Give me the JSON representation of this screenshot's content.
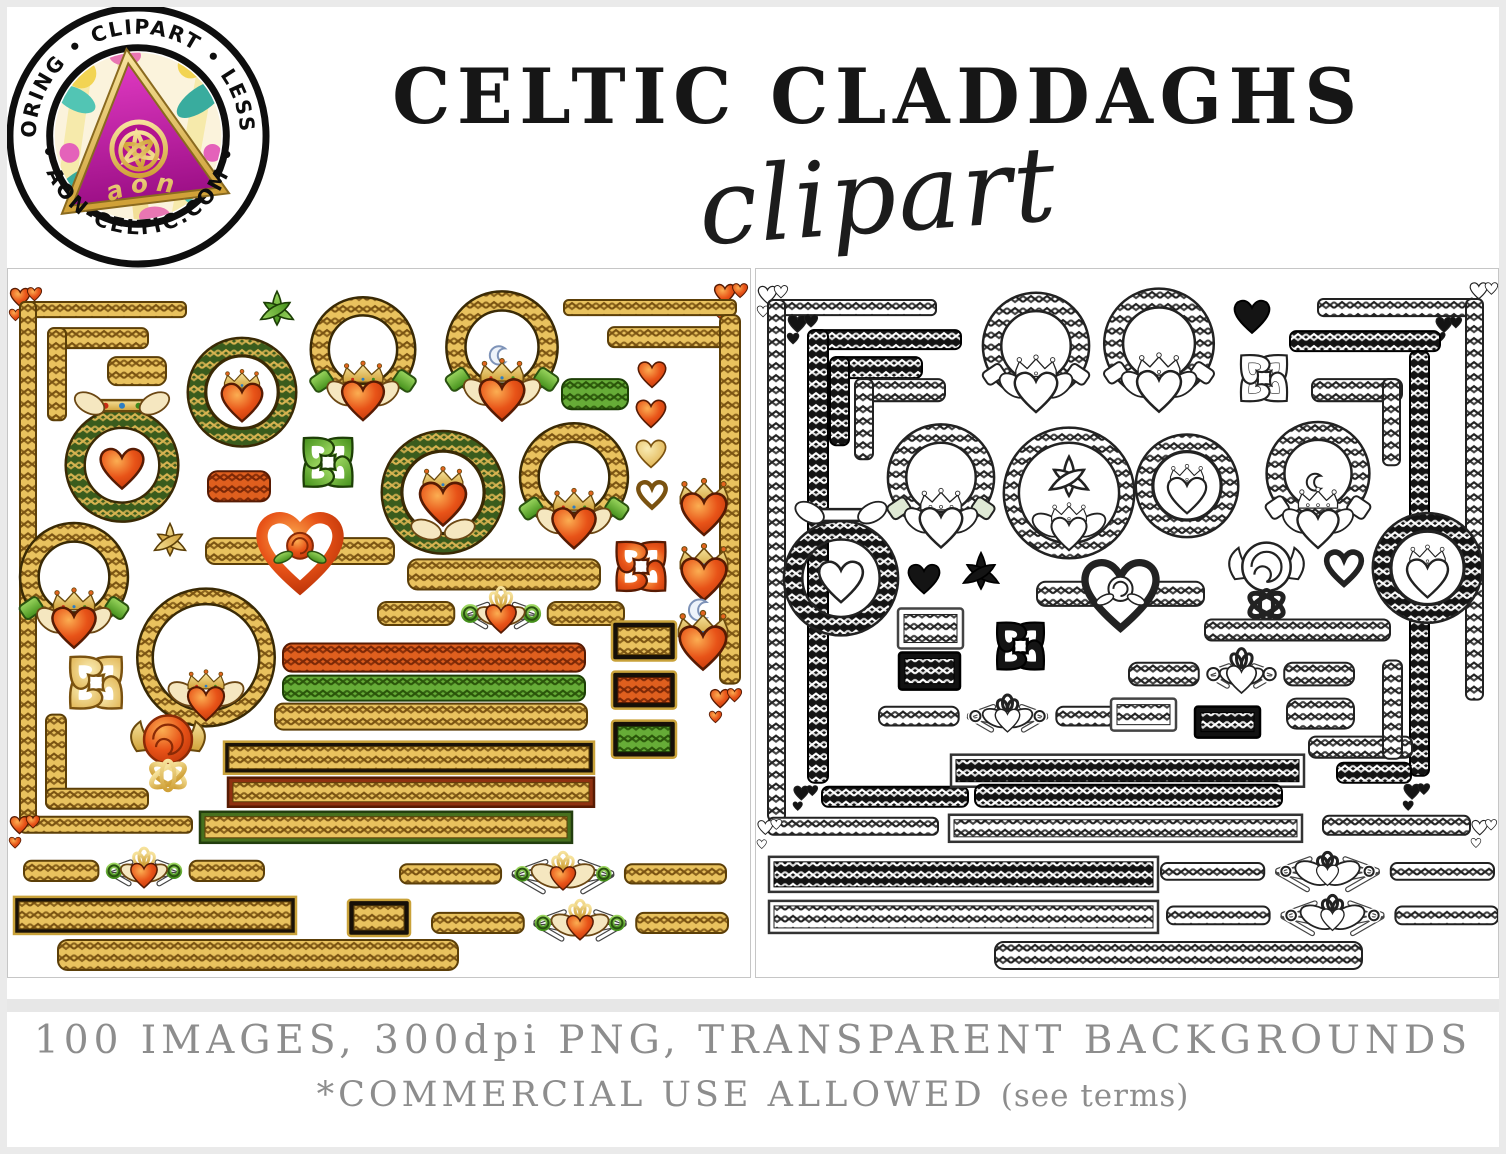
{
  "header": {
    "logo": {
      "ring_text_top": "COLORING • CLIPART • LESSONS",
      "ring_text_bottom": "• AON-CELTIC.COM •",
      "monogram": "aon"
    },
    "title": "CELTIC CLADDAGHS",
    "subtitle": "clipart"
  },
  "footer": {
    "line1": "100 IMAGES, 300dpi PNG, TRANSPARENT BACKGROUNDS",
    "line2_main": "*COMMERCIAL USE ALLOWED",
    "line2_note": "(see terms)",
    "text_color": "#8d8d8d"
  },
  "palette": {
    "schemes": {
      "gold": {
        "base": "#E9C25E",
        "lat": "#7A5312",
        "edge": "#5C3F08"
      },
      "orange": {
        "base": "#DF5F1E",
        "lat": "#7A2706",
        "edge": "#571B03"
      },
      "green": {
        "base": "#66AC37",
        "lat": "#295409",
        "edge": "#1D3F06"
      },
      "dgreen": {
        "base": "#3A5C1D",
        "lat": "#D8B451",
        "edge": "#233E0F"
      },
      "goldh": {
        "base": "#F0D78C",
        "lat": "#B98F2E",
        "edge": "#7A5210"
      },
      "bw": {
        "base": "#FFFFFF",
        "lat": "#222222",
        "edge": "#222222"
      },
      "black": {
        "base": "#141414",
        "lat": "#FFFFFF",
        "edge": "#000000"
      }
    },
    "heart_orange": [
      "#FBAE52",
      "#E85318",
      "#B93107"
    ],
    "heart_gold": [
      "#F9ECB4",
      "#DCA93F"
    ],
    "cuff_green": [
      "#9BD65F",
      "#44901B"
    ],
    "gold_metal": [
      "#F6E29B",
      "#D0A138"
    ],
    "magenta": [
      "#E23BC4",
      "#9C0F86"
    ],
    "cream": "#F5E7C0",
    "ink": "#222222"
  },
  "panels": {
    "left": {
      "name": "color-clipart-panel",
      "items": [
        {
          "t": "heartcluster",
          "x": 0,
          "y": 16,
          "w": 34,
          "h": 40,
          "s": "orange"
        },
        {
          "t": "bar",
          "x": 12,
          "y": 33,
          "w": 166,
          "h": 15,
          "s": "gold"
        },
        {
          "t": "vbar",
          "x": 12,
          "y": 33,
          "w": 16,
          "h": 520,
          "s": "gold"
        },
        {
          "t": "bar",
          "x": 12,
          "y": 547,
          "w": 172,
          "h": 16,
          "s": "gold"
        },
        {
          "t": "heartcluster",
          "x": 0,
          "y": 543,
          "w": 32,
          "h": 40,
          "s": "orange"
        },
        {
          "t": "bar",
          "x": 40,
          "y": 59,
          "w": 100,
          "h": 20,
          "s": "gold"
        },
        {
          "t": "vbar",
          "x": 40,
          "y": 59,
          "w": 18,
          "h": 92,
          "s": "gold"
        },
        {
          "t": "vbar",
          "x": 38,
          "y": 445,
          "w": 20,
          "h": 94,
          "s": "gold"
        },
        {
          "t": "bar",
          "x": 38,
          "y": 519,
          "w": 102,
          "h": 20,
          "s": "gold"
        },
        {
          "t": "bar",
          "x": 100,
          "y": 88,
          "w": 58,
          "h": 28,
          "s": "gold"
        },
        {
          "t": "cladtop",
          "x": 55,
          "y": 118,
          "w": 118,
          "h": 130,
          "s": "color",
          "ring": "dgreen"
        },
        {
          "t": "medallion",
          "x": 178,
          "y": 66,
          "w": 112,
          "h": 114,
          "s": "color",
          "ring": "dgreen"
        },
        {
          "t": "triq",
          "x": 250,
          "y": 20,
          "w": 38,
          "h": 42,
          "s": "green"
        },
        {
          "t": "clad",
          "x": 295,
          "y": 22,
          "w": 120,
          "h": 146,
          "s": "color"
        },
        {
          "t": "clad",
          "x": 430,
          "y": 18,
          "w": 128,
          "h": 150,
          "s": "color",
          "moon": true
        },
        {
          "t": "heartcluster",
          "x": 704,
          "y": 12,
          "w": 36,
          "h": 42,
          "s": "orange"
        },
        {
          "t": "bar",
          "x": 556,
          "y": 31,
          "w": 172,
          "h": 15,
          "s": "gold"
        },
        {
          "t": "bar",
          "x": 600,
          "y": 58,
          "w": 130,
          "h": 20,
          "s": "gold"
        },
        {
          "t": "vbar",
          "x": 712,
          "y": 46,
          "w": 20,
          "h": 368,
          "s": "gold"
        },
        {
          "t": "heartcluster",
          "x": 700,
          "y": 416,
          "w": 34,
          "h": 42,
          "s": "orange"
        },
        {
          "t": "heart",
          "x": 628,
          "y": 90,
          "w": 32,
          "h": 30,
          "s": "orange"
        },
        {
          "t": "heart",
          "x": 626,
          "y": 128,
          "w": 34,
          "h": 32,
          "s": "orange"
        },
        {
          "t": "heart",
          "x": 626,
          "y": 168,
          "w": 34,
          "h": 32,
          "s": "goldh"
        },
        {
          "t": "heart",
          "x": 628,
          "y": 210,
          "w": 32,
          "h": 30,
          "s": "goldh",
          "open": true
        },
        {
          "t": "bar",
          "x": 554,
          "y": 110,
          "w": 66,
          "h": 30,
          "s": "green"
        },
        {
          "t": "clover",
          "x": 287,
          "y": 158,
          "w": 66,
          "h": 70,
          "s": "green"
        },
        {
          "t": "bar",
          "x": 200,
          "y": 202,
          "w": 62,
          "h": 30,
          "s": "orange"
        },
        {
          "t": "triq",
          "x": 143,
          "y": 252,
          "w": 38,
          "h": 40,
          "s": "gold"
        },
        {
          "t": "heartband",
          "x": 198,
          "y": 246,
          "w": 188,
          "h": 76,
          "s": "color"
        },
        {
          "t": "medallion",
          "x": 372,
          "y": 150,
          "w": 126,
          "h": 146,
          "s": "color",
          "ring": "dgreen",
          "hands": true
        },
        {
          "t": "clad",
          "x": 504,
          "y": 150,
          "w": 124,
          "h": 145,
          "s": "color"
        },
        {
          "t": "crownheart",
          "x": 668,
          "y": 203,
          "w": 56,
          "h": 62,
          "s": "color"
        },
        {
          "t": "crownheart",
          "x": 668,
          "y": 268,
          "w": 56,
          "h": 62,
          "s": "color"
        },
        {
          "t": "crownheart",
          "x": 666,
          "y": 334,
          "w": 58,
          "h": 66,
          "s": "color",
          "moon": true
        },
        {
          "t": "clover",
          "x": 600,
          "y": 262,
          "w": 66,
          "h": 70,
          "s": "orange"
        },
        {
          "t": "clad",
          "x": 4,
          "y": 250,
          "w": 124,
          "h": 144,
          "s": "color"
        },
        {
          "t": "bar",
          "x": 400,
          "y": 290,
          "w": 192,
          "h": 30,
          "s": "gold"
        },
        {
          "t": "wreathclad",
          "x": 133,
          "y": 318,
          "w": 130,
          "h": 152,
          "s": "color"
        },
        {
          "t": "divider",
          "x": 370,
          "y": 320,
          "w": 246,
          "h": 48,
          "s": "color"
        },
        {
          "t": "clover",
          "x": 56,
          "y": 376,
          "w": 64,
          "h": 74,
          "s": "goldh"
        },
        {
          "t": "roseknot",
          "x": 114,
          "y": 441,
          "w": 92,
          "h": 90,
          "s": "color"
        },
        {
          "t": "bar",
          "x": 275,
          "y": 374,
          "w": 302,
          "h": 28,
          "s": "orange"
        },
        {
          "t": "bar",
          "x": 275,
          "y": 406,
          "w": 302,
          "h": 25,
          "s": "green"
        },
        {
          "t": "bar",
          "x": 267,
          "y": 434,
          "w": 312,
          "h": 26,
          "s": "gold"
        },
        {
          "t": "plaque",
          "x": 604,
          "y": 352,
          "w": 64,
          "h": 39,
          "s": "gold"
        },
        {
          "t": "plaque",
          "x": 604,
          "y": 402,
          "w": 64,
          "h": 37,
          "s": "orange"
        },
        {
          "t": "plaque",
          "x": 604,
          "y": 451,
          "w": 64,
          "h": 37,
          "s": "green"
        },
        {
          "t": "framedbar",
          "x": 216,
          "y": 472,
          "w": 370,
          "h": 32,
          "s": "gold",
          "f": "black"
        },
        {
          "t": "framedbar",
          "x": 220,
          "y": 508,
          "w": 366,
          "h": 29,
          "s": "gold",
          "f": "red"
        },
        {
          "t": "framedbar",
          "x": 192,
          "y": 542,
          "w": 372,
          "h": 31,
          "s": "gold",
          "f": "green"
        },
        {
          "t": "divider",
          "x": 16,
          "y": 580,
          "w": 240,
          "h": 42,
          "s": "color"
        },
        {
          "t": "divider",
          "x": 392,
          "y": 584,
          "w": 326,
          "h": 40,
          "s": "color"
        },
        {
          "t": "framedbar",
          "x": 6,
          "y": 627,
          "w": 282,
          "h": 37,
          "s": "gold",
          "f": "black"
        },
        {
          "t": "plaque",
          "x": 340,
          "y": 630,
          "w": 62,
          "h": 36,
          "s": "gold"
        },
        {
          "t": "divider",
          "x": 424,
          "y": 632,
          "w": 296,
          "h": 42,
          "s": "color"
        },
        {
          "t": "bar",
          "x": 50,
          "y": 670,
          "w": 400,
          "h": 30,
          "s": "gold"
        }
      ]
    },
    "right": {
      "name": "lineart-clipart-panel",
      "items": [
        {
          "t": "heartcluster",
          "x": 0,
          "y": 14,
          "w": 32,
          "h": 38,
          "s": "bw"
        },
        {
          "t": "bar",
          "x": 12,
          "y": 31,
          "w": 168,
          "h": 15,
          "s": "bw"
        },
        {
          "t": "vbar",
          "x": 12,
          "y": 31,
          "w": 17,
          "h": 520,
          "s": "bw"
        },
        {
          "t": "bar",
          "x": 12,
          "y": 548,
          "w": 170,
          "h": 17,
          "s": "bw"
        },
        {
          "t": "heartcluster",
          "x": 0,
          "y": 546,
          "w": 26,
          "h": 38,
          "s": "bw"
        },
        {
          "t": "heartcluster",
          "x": 30,
          "y": 44,
          "w": 32,
          "h": 34,
          "s": "black"
        },
        {
          "t": "bar",
          "x": 52,
          "y": 61,
          "w": 153,
          "h": 19,
          "s": "black"
        },
        {
          "t": "vbar",
          "x": 52,
          "y": 61,
          "w": 20,
          "h": 452,
          "s": "black"
        },
        {
          "t": "bar",
          "x": 66,
          "y": 517,
          "w": 146,
          "h": 20,
          "s": "black"
        },
        {
          "t": "heartcluster",
          "x": 36,
          "y": 514,
          "w": 26,
          "h": 30,
          "s": "black"
        },
        {
          "t": "bar",
          "x": 74,
          "y": 88,
          "w": 92,
          "h": 21,
          "s": "black"
        },
        {
          "t": "vbar",
          "x": 74,
          "y": 88,
          "w": 19,
          "h": 88,
          "s": "black"
        },
        {
          "t": "bar",
          "x": 99,
          "y": 110,
          "w": 90,
          "h": 22,
          "s": "bw"
        },
        {
          "t": "vbar",
          "x": 99,
          "y": 110,
          "w": 18,
          "h": 80,
          "s": "bw"
        },
        {
          "t": "clad",
          "x": 219,
          "y": 24,
          "w": 122,
          "h": 132,
          "s": "bw"
        },
        {
          "t": "clad",
          "x": 340,
          "y": 20,
          "w": 126,
          "h": 136,
          "s": "bw"
        },
        {
          "t": "heart",
          "x": 477,
          "y": 27,
          "w": 38,
          "h": 40,
          "s": "black"
        },
        {
          "t": "clover",
          "x": 472,
          "y": 76,
          "w": 72,
          "h": 66,
          "s": "bw"
        },
        {
          "t": "heartcluster",
          "x": 712,
          "y": 13,
          "w": 30,
          "h": 28,
          "s": "bw"
        },
        {
          "t": "bar",
          "x": 562,
          "y": 30,
          "w": 158,
          "h": 17,
          "s": "bw"
        },
        {
          "t": "vbar",
          "x": 710,
          "y": 30,
          "w": 17,
          "h": 400,
          "s": "bw"
        },
        {
          "t": "heartcluster",
          "x": 678,
          "y": 47,
          "w": 28,
          "h": 28,
          "s": "black"
        },
        {
          "t": "bar",
          "x": 534,
          "y": 62,
          "w": 150,
          "h": 20,
          "s": "black"
        },
        {
          "t": "vbar",
          "x": 654,
          "y": 82,
          "w": 19,
          "h": 424,
          "s": "black"
        },
        {
          "t": "heartcluster",
          "x": 646,
          "y": 512,
          "w": 28,
          "h": 32,
          "s": "black"
        },
        {
          "t": "bar",
          "x": 581,
          "y": 493,
          "w": 74,
          "h": 20,
          "s": "black"
        },
        {
          "t": "bar",
          "x": 556,
          "y": 110,
          "w": 90,
          "h": 22,
          "s": "bw"
        },
        {
          "t": "vbar",
          "x": 627,
          "y": 110,
          "w": 17,
          "h": 86,
          "s": "bw"
        },
        {
          "t": "cladtop",
          "x": 28,
          "y": 226,
          "w": 114,
          "h": 138,
          "s": "bw",
          "ring": "black"
        },
        {
          "t": "clad",
          "x": 124,
          "y": 151,
          "w": 122,
          "h": 143,
          "s": "bw",
          "cufftint": true
        },
        {
          "t": "wreathclad",
          "x": 250,
          "y": 162,
          "w": 126,
          "h": 134,
          "s": "bw",
          "triq": true
        },
        {
          "t": "heart",
          "x": 149,
          "y": 292,
          "w": 38,
          "h": 34,
          "s": "black"
        },
        {
          "t": "triq",
          "x": 206,
          "y": 281,
          "w": 38,
          "h": 45,
          "s": "black"
        },
        {
          "t": "medallion",
          "x": 378,
          "y": 159,
          "w": 106,
          "h": 115,
          "s": "bw"
        },
        {
          "t": "clad",
          "x": 503,
          "y": 141,
          "w": 118,
          "h": 158,
          "s": "bw",
          "moon": true
        },
        {
          "t": "medallion",
          "x": 615,
          "y": 236,
          "w": 113,
          "h": 125,
          "s": "bw",
          "ring": "black"
        },
        {
          "t": "heartband",
          "x": 281,
          "y": 291,
          "w": 167,
          "h": 71,
          "s": "bw"
        },
        {
          "t": "roseknot",
          "x": 464,
          "y": 267,
          "w": 93,
          "h": 95,
          "s": "bw"
        },
        {
          "t": "heart",
          "x": 569,
          "y": 279,
          "w": 38,
          "h": 38,
          "s": "bw",
          "open": true
        },
        {
          "t": "plaque",
          "x": 142,
          "y": 339,
          "w": 65,
          "h": 40,
          "s": "bwoutline"
        },
        {
          "t": "clover",
          "x": 228,
          "y": 343,
          "w": 73,
          "h": 67,
          "s": "black"
        },
        {
          "t": "plaque",
          "x": 143,
          "y": 383,
          "w": 61,
          "h": 37,
          "s": "blackplaque"
        },
        {
          "t": "bar",
          "x": 449,
          "y": 350,
          "w": 185,
          "h": 21,
          "s": "bw"
        },
        {
          "t": "divider",
          "x": 123,
          "y": 427,
          "w": 257,
          "h": 39,
          "s": "bw"
        },
        {
          "t": "divider",
          "x": 373,
          "y": 381,
          "w": 225,
          "h": 47,
          "s": "bw"
        },
        {
          "t": "plaque",
          "x": 355,
          "y": 429,
          "w": 65,
          "h": 32,
          "s": "bwoutline"
        },
        {
          "t": "plaque",
          "x": 439,
          "y": 437,
          "w": 65,
          "h": 31,
          "s": "blackplaque"
        },
        {
          "t": "bar",
          "x": 531,
          "y": 429,
          "w": 67,
          "h": 30,
          "s": "bw"
        },
        {
          "t": "bar",
          "x": 553,
          "y": 467,
          "w": 103,
          "h": 21,
          "s": "bw"
        },
        {
          "t": "vbar",
          "x": 627,
          "y": 391,
          "w": 19,
          "h": 98,
          "s": "bw"
        },
        {
          "t": "framedbar",
          "x": 195,
          "y": 485,
          "w": 353,
          "h": 32,
          "s": "black",
          "f": "outline"
        },
        {
          "t": "bar",
          "x": 219,
          "y": 515,
          "w": 307,
          "h": 22,
          "s": "black"
        },
        {
          "t": "framedbar",
          "x": 193,
          "y": 545,
          "w": 353,
          "h": 27,
          "s": "bw",
          "f": "outline"
        },
        {
          "t": "bar",
          "x": 567,
          "y": 546,
          "w": 147,
          "h": 19,
          "s": "bw"
        },
        {
          "t": "heartcluster",
          "x": 714,
          "y": 547,
          "w": 27,
          "h": 35,
          "s": "bw"
        },
        {
          "t": "framedbar",
          "x": 13,
          "y": 587,
          "w": 389,
          "h": 35,
          "s": "black",
          "f": "outline"
        },
        {
          "t": "divider",
          "x": 405,
          "y": 584,
          "w": 333,
          "h": 35,
          "s": "bw"
        },
        {
          "t": "framedbar",
          "x": 13,
          "y": 631,
          "w": 389,
          "h": 32,
          "s": "bw",
          "f": "outline"
        },
        {
          "t": "divider",
          "x": 411,
          "y": 627,
          "w": 331,
          "h": 37,
          "s": "bw"
        },
        {
          "t": "bar",
          "x": 239,
          "y": 672,
          "w": 367,
          "h": 27,
          "s": "bw"
        }
      ]
    }
  }
}
